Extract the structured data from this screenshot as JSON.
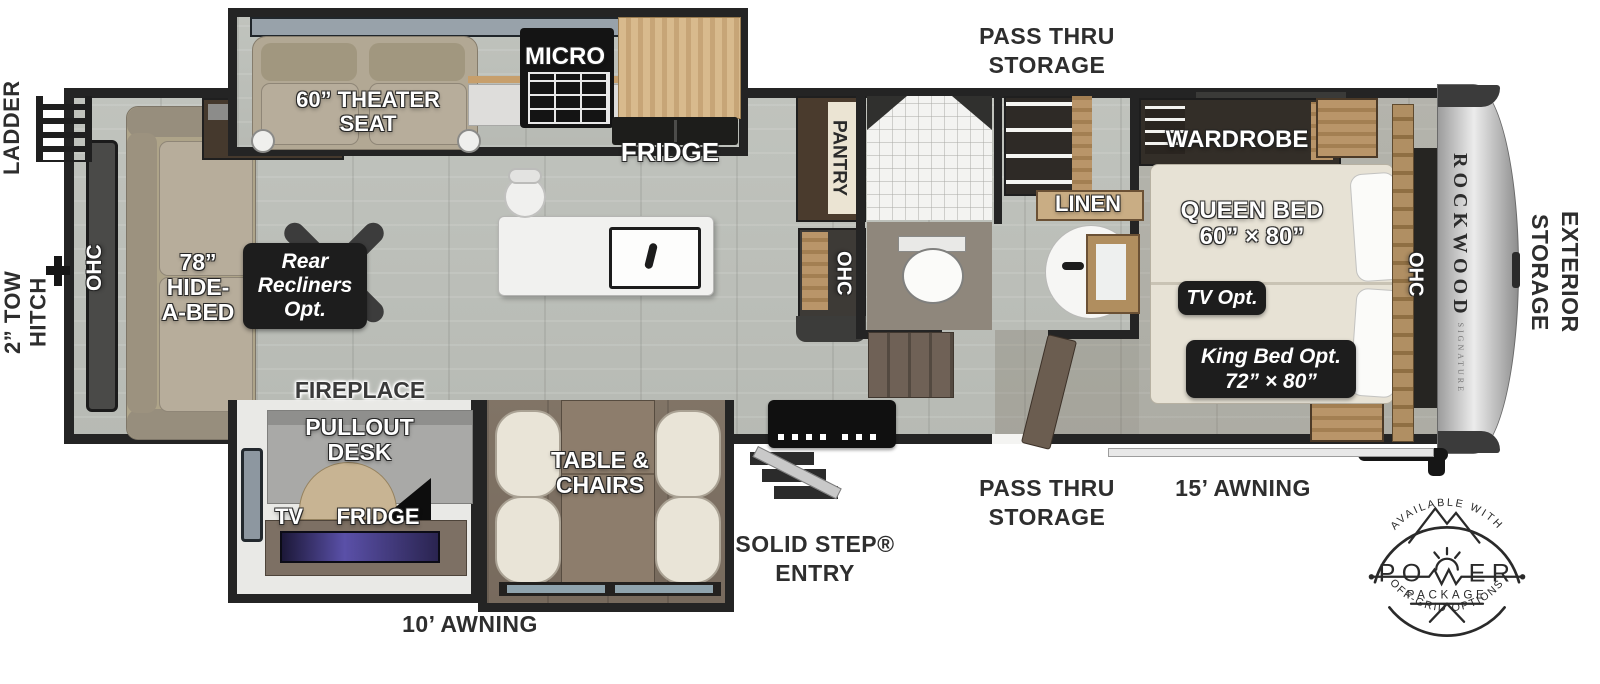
{
  "colors": {
    "wall": "#242424",
    "floor_gray": "#bcc0ba",
    "floor_brown": "#7b6e61",
    "badge_bg": "#1d1d1d",
    "cabinet_wood": "#d2b488",
    "front_cap": "#d6d6d6"
  },
  "exterior": {
    "ladder": "LADDER",
    "tow_hitch_line1": "2” TOW",
    "tow_hitch_line2": "HITCH",
    "pass_thru_top_line1": "PASS THRU",
    "pass_thru_top_line2": "STORAGE",
    "pass_thru_bottom_line1": "PASS THRU",
    "pass_thru_bottom_line2": "STORAGE",
    "solid_step_line1": "SOLID STEP®",
    "solid_step_line2": "ENTRY",
    "awning_front": "15’ AWNING",
    "awning_rear": "10’ AWNING",
    "exterior_storage_line1": "EXTERIOR",
    "exterior_storage_line2": "STORAGE",
    "brand": "ROCKWOOD",
    "brand_series": "SIGNATURE"
  },
  "living": {
    "ohc_rear": "OHC",
    "hide_a_bed_line1": "78”",
    "hide_a_bed_line2": "HIDE-",
    "hide_a_bed_line3": "A-BED",
    "theater_line1": "60” THEATER",
    "theater_line2": "SEAT",
    "recliners_line1": "Rear",
    "recliners_line2": "Recliners",
    "recliners_line3": "Opt.",
    "fireplace": "FIREPLACE",
    "pullout_line1": "PULLOUT",
    "pullout_line2": "DESK",
    "tv": "TV",
    "fridge": "FRIDGE",
    "table_line1": "TABLE &",
    "table_line2": "CHAIRS"
  },
  "kitchen": {
    "micro": "MICRO",
    "fridge": "FRIDGE",
    "pantry": "PANTRY",
    "ohc": "OHC"
  },
  "bath": {
    "linen": "LINEN"
  },
  "bedroom": {
    "wardrobe": "WARDROBE",
    "queen_line1": "QUEEN BED",
    "queen_line2": "60” × 80”",
    "tv_opt": "TV Opt.",
    "king_line1": "King Bed Opt.",
    "king_line2": "72” × 80”",
    "ohc": "OHC"
  },
  "power_badge": {
    "arc_top": "AVAILABLE WITH",
    "word_start": "PO",
    "word_end": "ER",
    "package": "PACKAGE",
    "arc_bottom": "OFF-GRID OPTIONS"
  }
}
